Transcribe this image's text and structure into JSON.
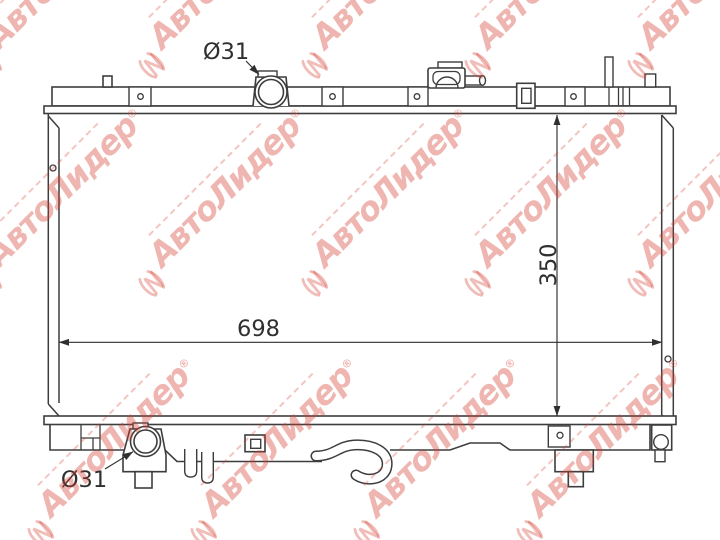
{
  "diagram": {
    "dimensions": {
      "top_neck_diameter": "Ø31",
      "core_width": "698",
      "core_height": "350",
      "bottom_outlet_diameter": "Ø31"
    }
  },
  "watermark": {
    "brand": "АвтоЛидер",
    "registered_mark": "®",
    "color": "#d63e32"
  },
  "colors": {
    "background": "#ffffff",
    "line": "#3d3d3d",
    "watermark_pink": "rgba(214,62,50,0.38)"
  }
}
